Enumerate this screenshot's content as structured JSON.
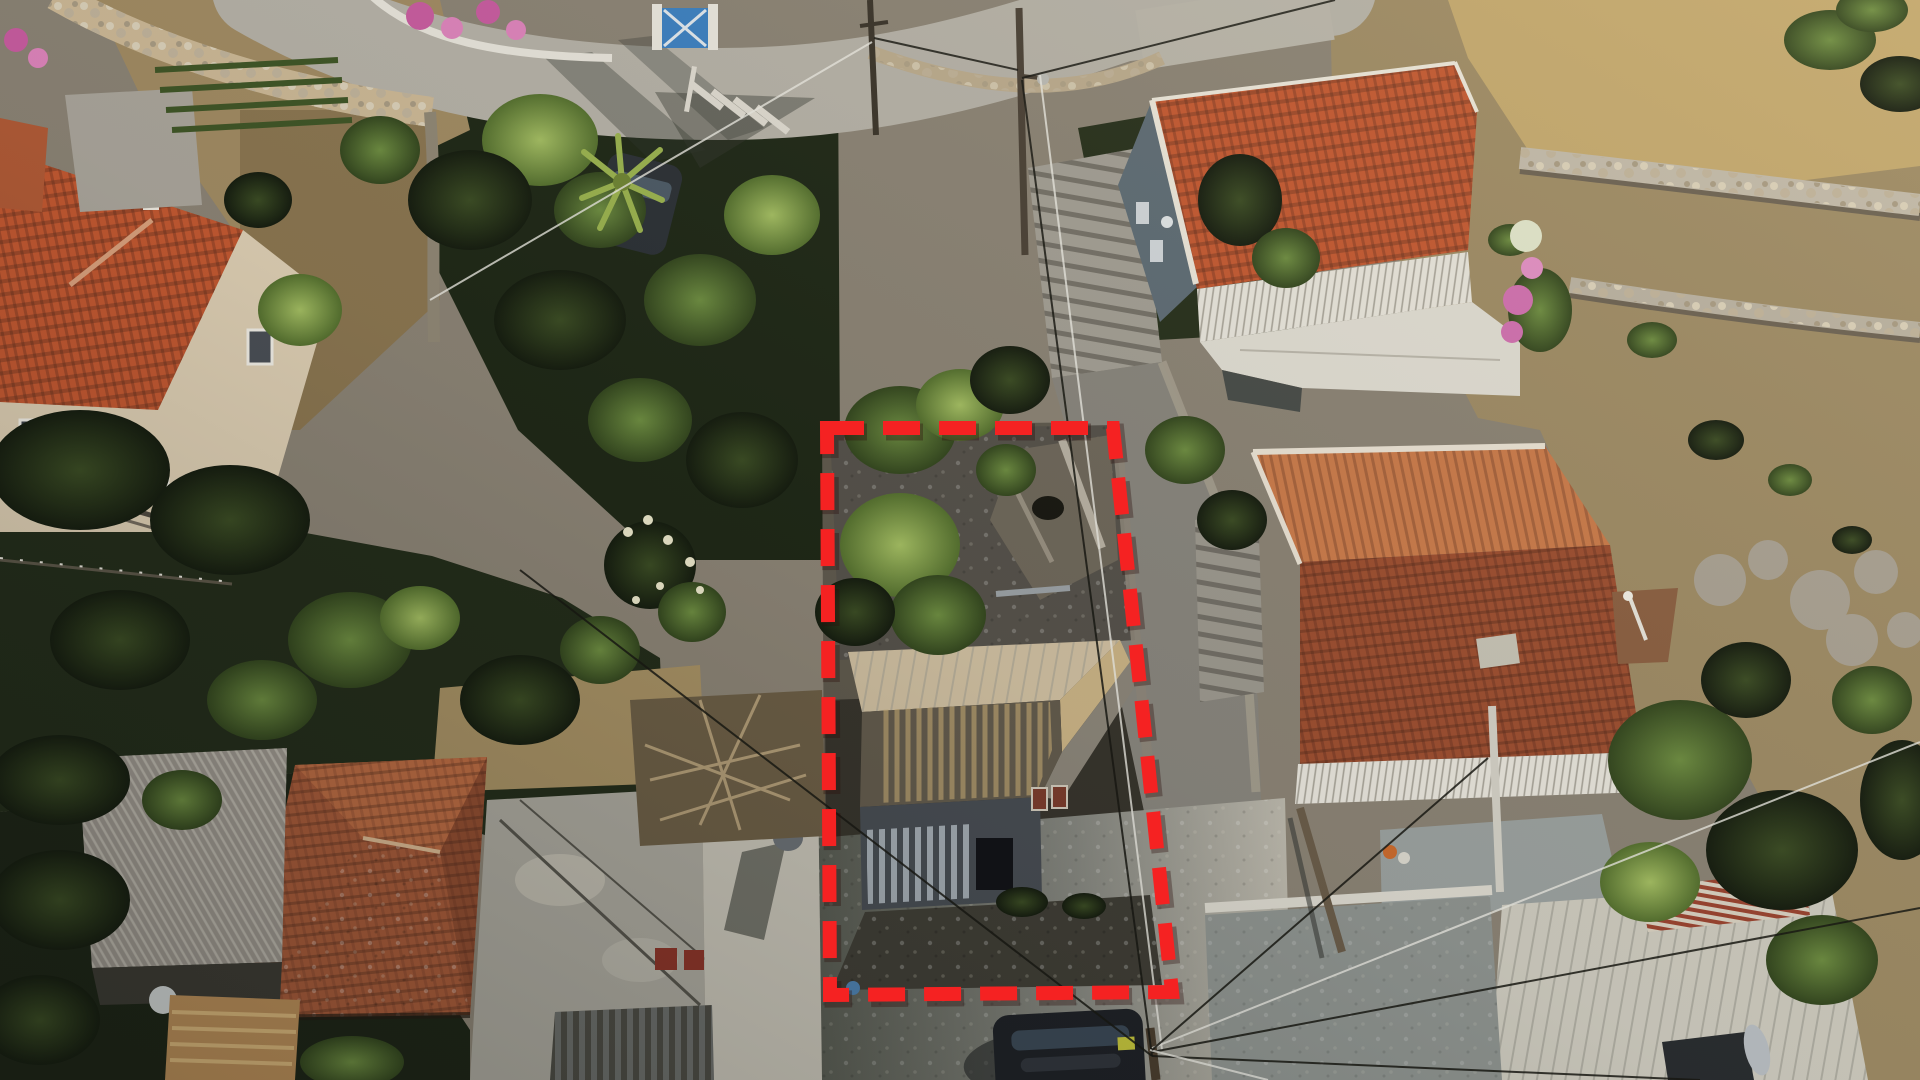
{
  "scene": {
    "type": "aerial-drone-photograph",
    "subject": "Top-down drone photo of a Greek hillside village plot: a derelict stone house and overgrown garden outlined by a red dashed property-boundary overlay, surrounded by terracotta-roofed villas, a concrete village road, power lines and dry rocky terraces",
    "lighting": "low evening sun from the upper right, long shadows toward lower left",
    "visible_text": []
  },
  "boundary": {
    "label": "marked property boundary",
    "points": "827,428 1113,428 1172,992 830,995",
    "color": "#f52222",
    "dash": "37 19",
    "width": 14
  },
  "palette": {
    "ground": "#8a8274",
    "road": "#b4b0a6",
    "road_sunlit": "#c7c3b8",
    "road_shadow": "#5d5f5b",
    "roof_terracotta_bright": "#c25831",
    "roof_terracotta_dark": "#9c4e30",
    "roof_terracotta_old": "#a65a39",
    "roof_weathered": "#9a948c",
    "roof_white_metal": "#cdcabe",
    "wall_cream": "#dccdb2",
    "wall_white": "#e6e3da",
    "derelict_roof_sunlit": "#cdbd9f",
    "derelict_roof_shadow": "#625a4c",
    "vegetation_dark": "#222c18",
    "vegetation_mid": "#45602c",
    "vegetation_sunlit": "#7d9c4a",
    "dry_field": "#c2a76d",
    "hillside": "#9d8a64",
    "stone_wall": "#c0b8a8",
    "car": "#1e2126",
    "bucket_blue": "#4d7fae",
    "gate_blue": "#3b7fc0",
    "flowers_pink": "#c75b9f"
  },
  "objects": [
    {
      "name": "property-boundary",
      "label": "red dashed plot outline"
    },
    {
      "name": "derelict-house",
      "label": "ruined stone house with collapsed corrugated roof inside the plot"
    },
    {
      "name": "plot-garden",
      "label": "overgrown plot with trees, rubble and stone ruins"
    },
    {
      "name": "north-villa",
      "label": "white two-storey villa with bright terracotta roof and balustraded veranda, top right"
    },
    {
      "name": "east-villa",
      "label": "large villa with dark terracotta roof and balcony, right of plot"
    },
    {
      "name": "cream-villa",
      "label": "cream two-storey house with terracotta hip roof, top left"
    },
    {
      "name": "old-tile-roof-house",
      "label": "old weathered terracotta hip roof house, bottom left"
    },
    {
      "name": "shed-weathered-roof",
      "label": "grey weathered shed roof beside old house"
    },
    {
      "name": "flat-roof-house",
      "label": "flat concrete roof building with water tank"
    },
    {
      "name": "white-metal-roof-house",
      "label": "white ribbed-metal roof house with solar water heater, bottom right"
    },
    {
      "name": "village-road",
      "label": "concrete village road with junction markings"
    },
    {
      "name": "stepped-alley",
      "label": "stepped concrete alley between plot and east villa"
    },
    {
      "name": "parked-car",
      "label": "dark parked car on lower road"
    },
    {
      "name": "second-parked-car",
      "label": "dark car parked at road edge near junction"
    },
    {
      "name": "utility-poles-and-wires",
      "label": "wooden utility poles with crossing power lines"
    },
    {
      "name": "stone-terrace-walls",
      "label": "dry-stone terrace walls on hillside"
    },
    {
      "name": "hillside-scrub",
      "label": "dry golden hillside with rocks and shrubs"
    },
    {
      "name": "yucca-plants",
      "label": "yucca plants with white bloom spikes"
    },
    {
      "name": "bougainvillea",
      "label": "pink bougainvillea along fences"
    },
    {
      "name": "blue-gate",
      "label": "blue double gate at driveway, top of frame"
    }
  ]
}
